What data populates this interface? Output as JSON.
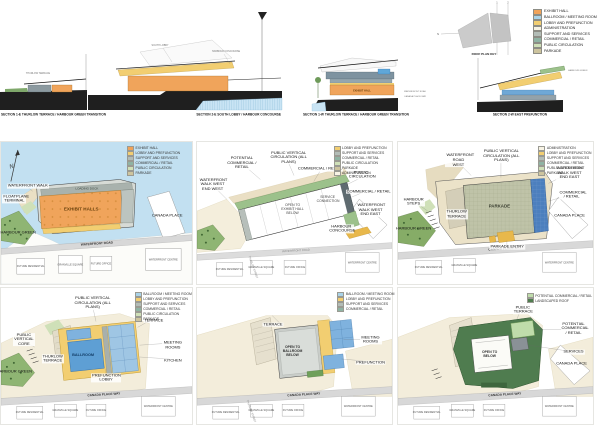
{
  "sections": {
    "s1e": {
      "caption": "SECTION 1-E THURLOW TERRACE / HARBOUR GREEN TRANSITION",
      "notes": [
        "THURLOW TERRACE",
        "EXHIBIT HALL"
      ]
    },
    "s2e": {
      "caption": "SECTION 2-E SOUTH LOBBY / HARBOUR CONCOURSE",
      "notes": [
        "SOUTH LOBBY",
        "HARBOUR CONCOURSE"
      ]
    },
    "s1w": {
      "caption": "SECTION 1-W THURLOW TERRACE / HARBOUR GREEN TRANSITION",
      "notes": [
        "EXHIBIT HALL",
        "WATERFRONT ROAD",
        "CANADA PLACE WAY"
      ]
    },
    "s2w": {
      "caption": "SECTION 2-W EAST PREFUNCTION",
      "notes": [
        "HARBOUR GREEN"
      ]
    }
  },
  "roof_key": {
    "caption": "ROOF PLAN KEY",
    "marks": [
      "1",
      "2",
      "N"
    ]
  },
  "legend": {
    "items": [
      {
        "label": "EXHIBIT HALL",
        "color": "#F0A35A"
      },
      {
        "label": "BALLROOM / MEETING ROOM",
        "color": "#A9D3E9"
      },
      {
        "label": "LOBBY AND PREFUNCTION",
        "color": "#F2CE71"
      },
      {
        "label": "ADMINISTRATION",
        "color": "#F7F3E4"
      },
      {
        "label": "SUPPORT AND SERVICES",
        "color": "#B3BDB7"
      },
      {
        "label": "COMMERCIAL / RETAIL",
        "color": "#8FB3A3"
      },
      {
        "label": "PUBLIC CIRCULATION",
        "color": "#CFE0B8"
      },
      {
        "label": "PARKADE",
        "color": "#CDC49E"
      }
    ]
  },
  "plans": [
    {
      "id": "exhibit-level",
      "compass": "N",
      "legend": [
        {
          "label": "EXHIBIT HALL",
          "color": "#F0A35A"
        },
        {
          "label": "LOBBY AND PREFUNCTION",
          "color": "#F2CE71"
        },
        {
          "label": "SUPPORT AND SERVICES",
          "color": "#B3BDB7"
        },
        {
          "label": "COMMERCIAL / RETAIL",
          "color": "#8FB3A3"
        },
        {
          "label": "PUBLIC CIRCULATION",
          "color": "#CFE0B8"
        },
        {
          "label": "PARKADE",
          "color": "#CDC49E"
        }
      ],
      "rooms": [
        "EXHIBIT HALLS",
        "LOADING DOCK"
      ],
      "road": "WATERFRONT ROAD",
      "callouts": [
        "FLOATPLANE TERMINAL",
        "WATERFRONT WALK",
        "HARBOUR GREEN",
        "CANADA PLACE"
      ],
      "blocks": [
        "FUTURE RESIDENTIAL",
        "GRANVILLE SQUARE",
        "FUTURE OFFICE",
        "WATERFRONT CENTRE"
      ]
    },
    {
      "id": "concourse-level",
      "legend": [
        {
          "label": "LOBBY AND PREFUNCTION",
          "color": "#F2CE71"
        },
        {
          "label": "SUPPORT AND SERVICES",
          "color": "#B3BDB7"
        },
        {
          "label": "COMMERCIAL / RETAIL",
          "color": "#8FB3A3"
        },
        {
          "label": "PUBLIC CIRCULATION",
          "color": "#CFE0B8"
        },
        {
          "label": "PARKADE",
          "color": "#CDC49E"
        },
        {
          "label": "ADMINISTRATION",
          "color": "#F7F3E4"
        }
      ],
      "rooms": [
        "OPEN TO EXHIBIT HALL BELOW",
        "SERVICE CONNECTION"
      ],
      "road": "WATERFRONT ROAD",
      "street": "THURLOW STREET",
      "callouts": [
        "POTENTIAL COMMERCIAL / RETAIL",
        "WATERFRONT WALK WEST END WEST",
        "PUBLIC VERTICAL CIRCULATION (ALL PLANS)",
        "COMMERCIAL / RETAIL",
        "PUBLIC CIRCULATION",
        "COMMERCIAL / RETAIL",
        "WATERFRONT WALK WEST END EAST",
        "HARBOUR CONCOURSE"
      ],
      "blocks": [
        "FUTURE RESIDENTIAL",
        "GRANVILLE SQUARE",
        "FUTURE OFFICE",
        "WATERFRONT CENTRE"
      ]
    },
    {
      "id": "parkade-level",
      "legend": [
        {
          "label": "ADMINISTRATION",
          "color": "#F7F3E4"
        },
        {
          "label": "LOBBY AND PREFUNCTION",
          "color": "#F2CE71"
        },
        {
          "label": "SUPPORT AND SERVICES",
          "color": "#B3BDB7"
        },
        {
          "label": "COMMERCIAL / RETAIL",
          "color": "#8FB3A3"
        },
        {
          "label": "PUBLIC CIRCULATION",
          "color": "#CFE0B8"
        },
        {
          "label": "PARKADE",
          "color": "#CDC49E"
        }
      ],
      "rooms": [
        "PARKADE"
      ],
      "road": "CANADA PLACE WAY",
      "callouts": [
        "WATERFRONT ROAD WEST",
        "PUBLIC VERTICAL CIRCULATION (ALL PLANS)",
        "WATERFRONT WALK WEST END EAST",
        "COMMERCIAL / RETAIL",
        "HARBOUR STEPS",
        "HARBOUR GREEN",
        "THURLOW TERRACE",
        "PARKADE ENTRY",
        "CANADA PLACE"
      ],
      "blocks": [
        "FUTURE RESIDENTIAL",
        "GRANVILLE SQUARE",
        "WATERFRONT CENTRE"
      ]
    },
    {
      "id": "ballroom-level",
      "legend": [
        {
          "label": "BALLROOM / MEETING ROOM",
          "color": "#A9D3E9"
        },
        {
          "label": "LOBBY AND PREFUNCTION",
          "color": "#F2CE71"
        },
        {
          "label": "SUPPORT AND SERVICES",
          "color": "#B3BDB7"
        },
        {
          "label": "COMMERCIAL / RETAIL",
          "color": "#8FB3A3"
        },
        {
          "label": "PUBLIC CIRCULATION",
          "color": "#CFE0B8"
        },
        {
          "label": "PARKADE",
          "color": "#CDC49E"
        }
      ],
      "rooms": [
        "BALLROOM"
      ],
      "road": "CANADA PLACE WAY",
      "callouts": [
        "PUBLIC VERTICAL CIRCULATION (ALL PLANS)",
        "TERRACE",
        "MEETING ROOMS",
        "KITCHEN",
        "PREFUNCTION LOBBY",
        "HARBOUR GREEN",
        "THURLOW TERRACE",
        "PUBLIC VERTICAL CORE"
      ],
      "blocks": [
        "FUTURE RESIDENTIAL",
        "GRANVILLE SQUARE",
        "FUTURE OFFICE",
        "WATERFRONT CENTRE"
      ]
    },
    {
      "id": "meeting-level",
      "legend": [
        {
          "label": "BALLROOM / MEETING ROOM",
          "color": "#A9D3E9"
        },
        {
          "label": "LOBBY AND PREFUNCTION",
          "color": "#F2CE71"
        },
        {
          "label": "SUPPORT AND SERVICES",
          "color": "#B3BDB7"
        },
        {
          "label": "COMMERCIAL / RETAIL",
          "color": "#8FB3A3"
        }
      ],
      "rooms": [
        "OPEN TO BALLROOM BELOW"
      ],
      "road": "CANADA PLACE WAY",
      "street": "THURLOW STREET",
      "callouts": [
        "TERRACE",
        "MEETING ROOMS",
        "PREFUNCTION"
      ],
      "blocks": [
        "FUTURE RESIDENTIAL",
        "GRANVILLE SQUARE",
        "FUTURE OFFICE",
        "WATERFRONT CENTRE"
      ]
    },
    {
      "id": "roof-level",
      "legend": [
        {
          "label": "POTENTIAL COMMERCIAL / RETAIL",
          "color": "#BFDCAB"
        },
        {
          "label": "LANDSCAPED ROOF",
          "color": "#4F7C4F"
        }
      ],
      "rooms": [
        "OPEN TO BELOW"
      ],
      "road": "CANADA PLACE WAY",
      "callouts": [
        "PUBLIC TERRACE",
        "POTENTIAL COMMERCIAL / RETAIL",
        "SERVICES",
        "CANADA PLACE"
      ],
      "blocks": [
        "FUTURE RESIDENTIAL",
        "GRANVILLE SQUARE",
        "FUTURE OFFICE",
        "WATERFRONT CENTRE"
      ]
    }
  ]
}
